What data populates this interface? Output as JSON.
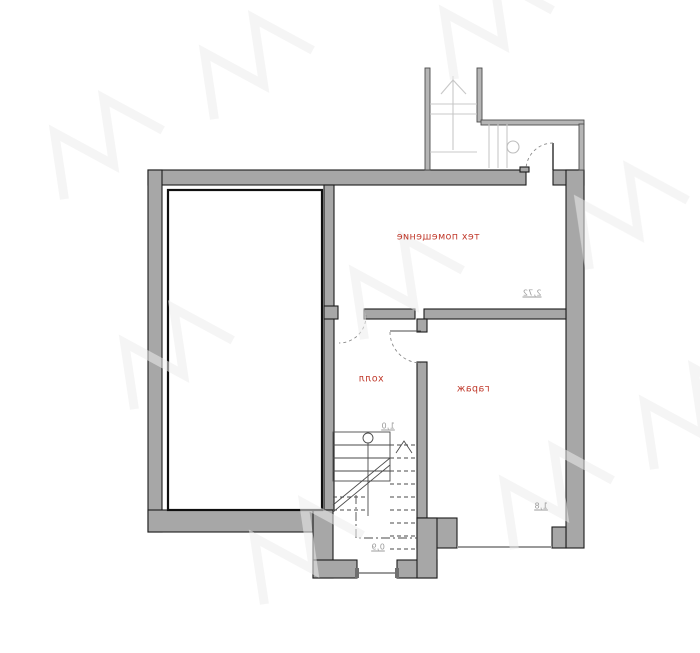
{
  "floor_plan": {
    "room_labels": {
      "tech_room": "тех помещение",
      "hall": "холл",
      "garage": "гараж"
    },
    "dimension_labels": {
      "near_tech_room": "2,72",
      "near_hall_door": "1,0",
      "near_garage_gate": "1,8",
      "near_stairs": "0,9"
    },
    "colors": {
      "wall_fill": "#a7a7a7",
      "wall_outline": "#1c1c1c",
      "porch_wall_fill": "#b5b5b5",
      "room_label_text": "#c0392b",
      "dimension_text": "#9b9b9b",
      "stair_light_lines": "#c8c8c8",
      "stair_dark_lines": "#4a4a4a",
      "watermark": "#ededed"
    }
  }
}
